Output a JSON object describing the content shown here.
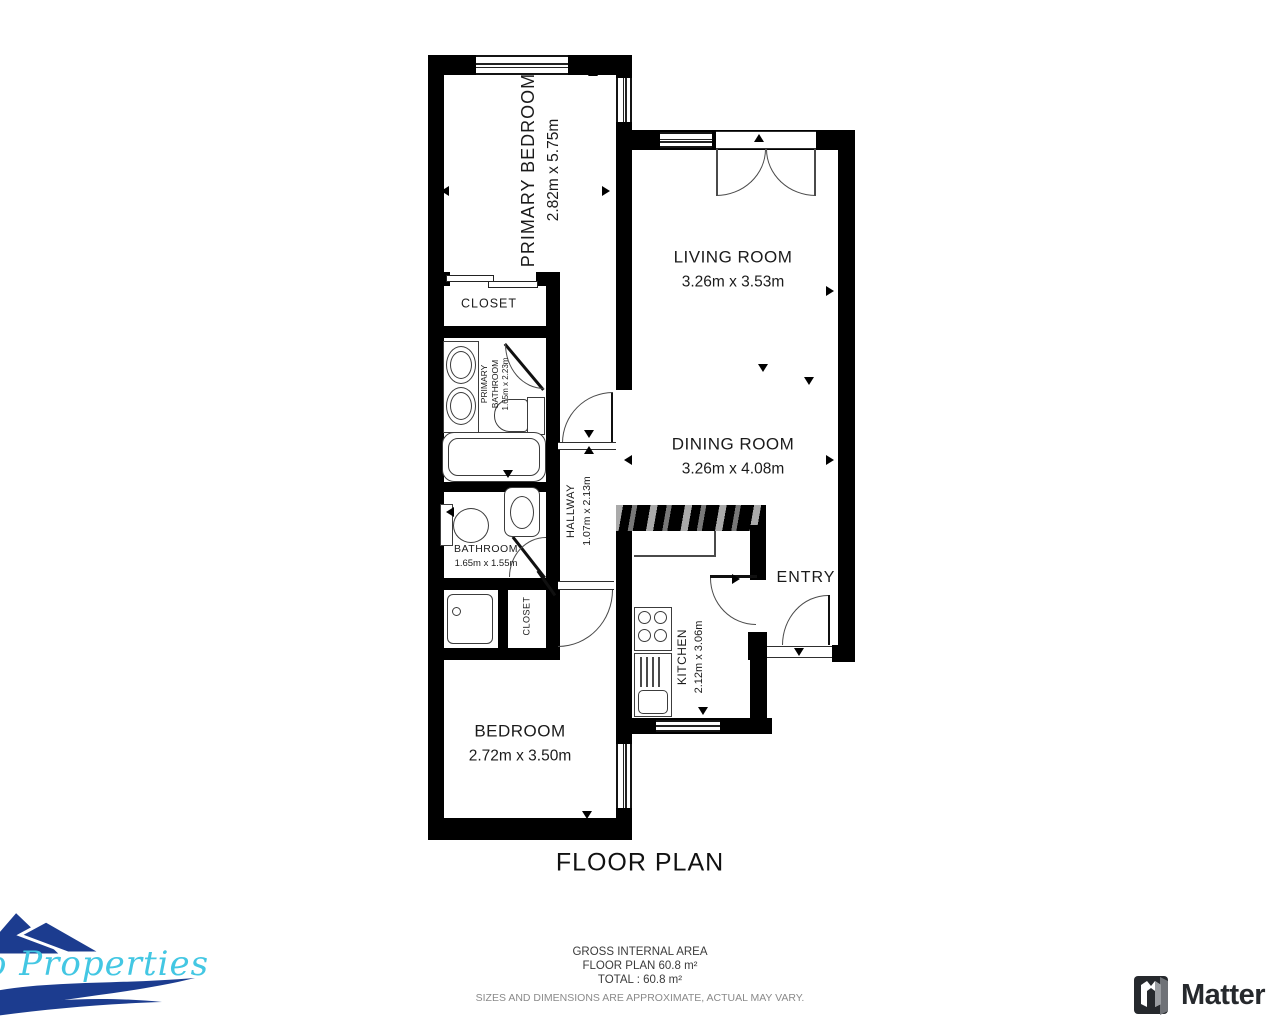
{
  "title": "FLOOR PLAN",
  "rooms": {
    "primary_bedroom": {
      "name": "PRIMARY BEDROOM",
      "dims": "2.82m x 5.75m"
    },
    "living_room": {
      "name": "LIVING ROOM",
      "dims": "3.26m x 3.53m"
    },
    "dining_room": {
      "name": "DINING ROOM",
      "dims": "3.26m x 4.08m"
    },
    "kitchen": {
      "name": "KITCHEN",
      "dims": "2.12m x 3.06m"
    },
    "bedroom": {
      "name": "BEDROOM",
      "dims": "2.72m x 3.50m"
    },
    "hallway": {
      "name": "HALLWAY",
      "dims": "1.07m x 2.13m"
    },
    "primary_bathroom": {
      "name": "PRIMARY BATHROOM",
      "dims": "1.65m x 2.23m"
    },
    "bathroom": {
      "name": "BATHROOM",
      "dims": "1.65m x 1.55m"
    },
    "entry": {
      "name": "ENTRY"
    },
    "closet_primary": {
      "name": "CLOSET"
    },
    "closet_bedroom": {
      "name": "CLOSET"
    }
  },
  "footer": {
    "line1": "GROSS INTERNAL AREA",
    "line2": "FLOOR PLAN 60.8 m²",
    "line3": "TOTAL :  60.8 m²",
    "disclaimer": "SIZES AND DIMENSIONS ARE APPROXIMATE, ACTUAL MAY VARY."
  },
  "branding": {
    "agency_name_visible": "o Properties",
    "matterport_wordmark": "Matter",
    "colors": {
      "mountains": "#1c3c8f",
      "script": "#43c7e3",
      "wave": "#1c3c8f",
      "matterport": "#26292d"
    }
  }
}
